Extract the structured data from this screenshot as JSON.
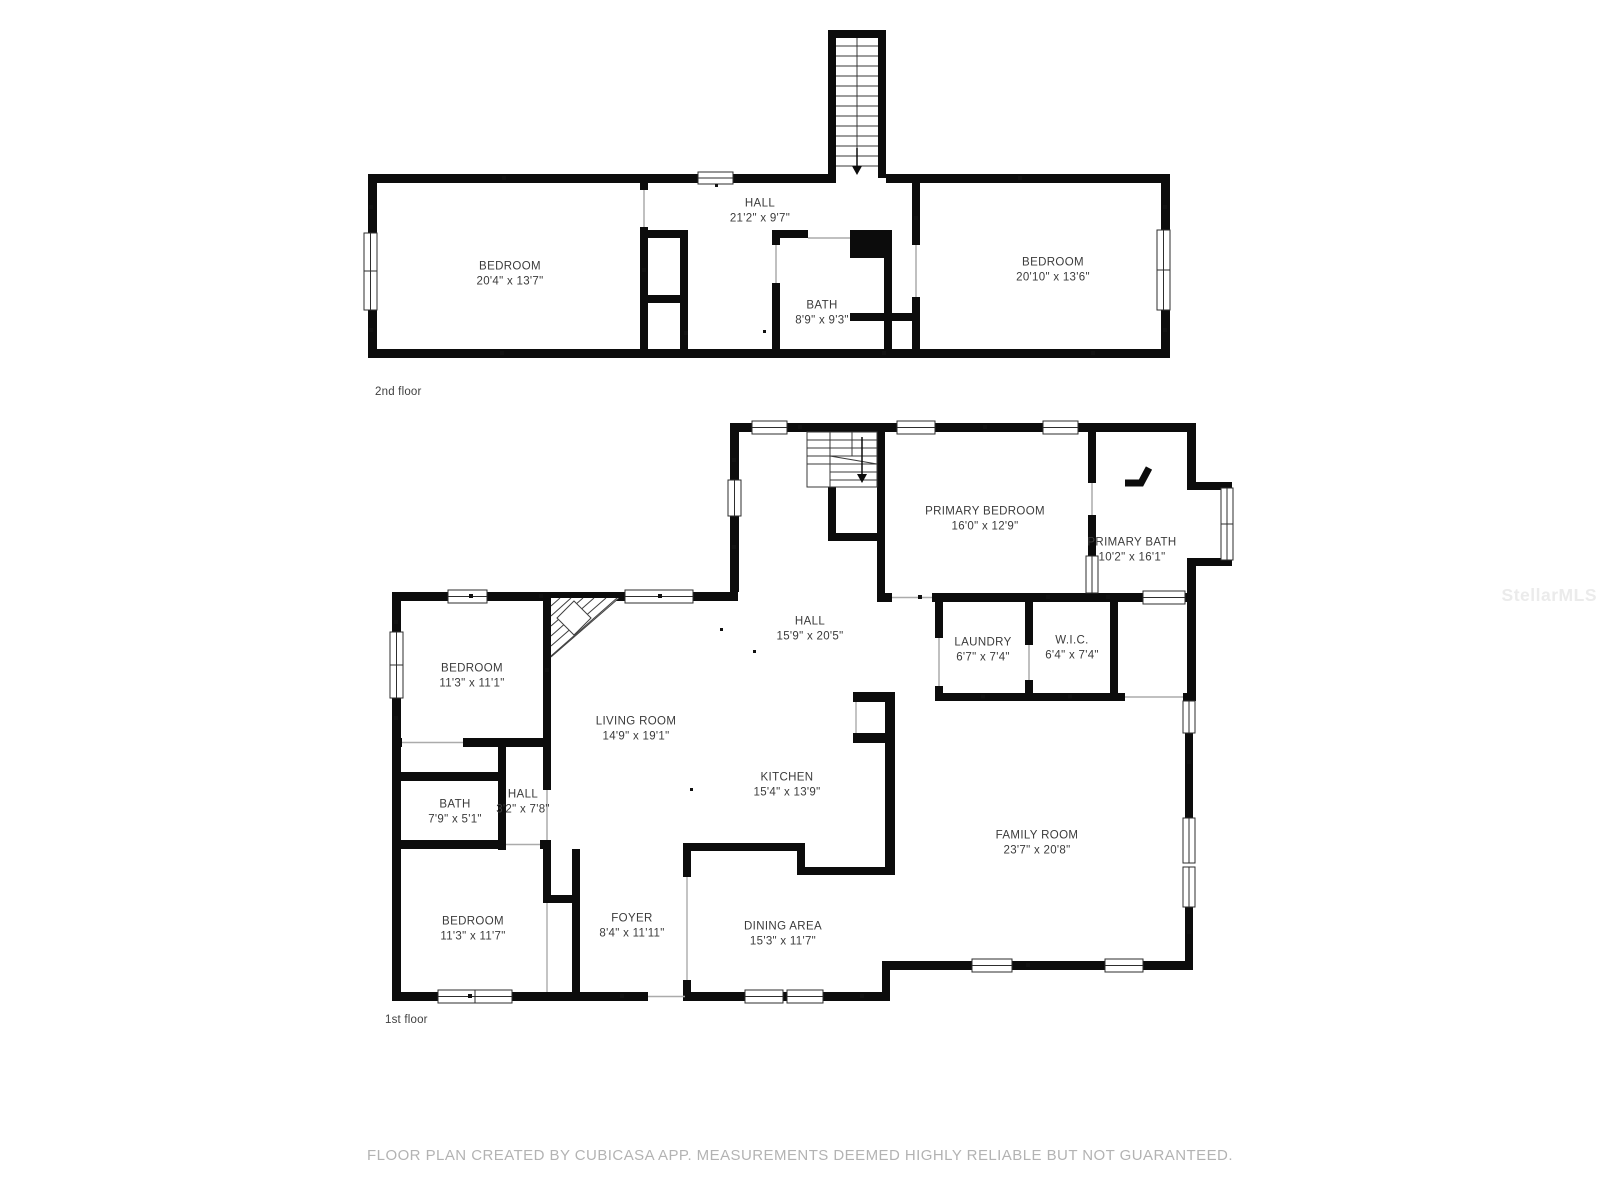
{
  "page": {
    "background": "#ffffff"
  },
  "colors": {
    "wall": "#0c0c0c",
    "room_label": "#3b3b3b",
    "caption": "#b3b3b3",
    "watermark": "#ebebeb"
  },
  "watermark": {
    "text": "StellarMLS"
  },
  "caption": {
    "text": "FLOOR PLAN CREATED BY CUBICASA APP. MEASUREMENTS DEEMED HIGHLY RELIABLE BUT NOT GUARANTEED."
  },
  "floors": [
    {
      "label": "2nd floor",
      "rooms": [
        {
          "name": "BEDROOM",
          "dims": "20'4\" x 13'7\""
        },
        {
          "name": "HALL",
          "dims": "21'2\" x 9'7\""
        },
        {
          "name": "BATH",
          "dims": "8'9\" x 9'3\""
        },
        {
          "name": "BEDROOM",
          "dims": "20'10\" x 13'6\""
        }
      ]
    },
    {
      "label": "1st floor",
      "rooms": [
        {
          "name": "PRIMARY BEDROOM",
          "dims": "16'0\" x 12'9\""
        },
        {
          "name": "PRIMARY BATH",
          "dims": "10'2\" x 16'1\""
        },
        {
          "name": "HALL",
          "dims": "15'9\" x 20'5\""
        },
        {
          "name": "LAUNDRY",
          "dims": "6'7\" x 7'4\""
        },
        {
          "name": "W.I.C.",
          "dims": "6'4\" x 7'4\""
        },
        {
          "name": "BEDROOM",
          "dims": "11'3\" x 11'1\""
        },
        {
          "name": "LIVING ROOM",
          "dims": "14'9\" x 19'1\""
        },
        {
          "name": "KITCHEN",
          "dims": "15'4\" x 13'9\""
        },
        {
          "name": "BATH",
          "dims": "7'9\" x 5'1\""
        },
        {
          "name": "HALL",
          "dims": "3'2\" x 7'8\""
        },
        {
          "name": "BEDROOM",
          "dims": "11'3\" x 11'7\""
        },
        {
          "name": "FOYER",
          "dims": "8'4\" x 11'11\""
        },
        {
          "name": "DINING AREA",
          "dims": "15'3\" x 11'7\""
        },
        {
          "name": "FAMILY ROOM",
          "dims": "23'7\" x 20'8\""
        }
      ]
    }
  ]
}
